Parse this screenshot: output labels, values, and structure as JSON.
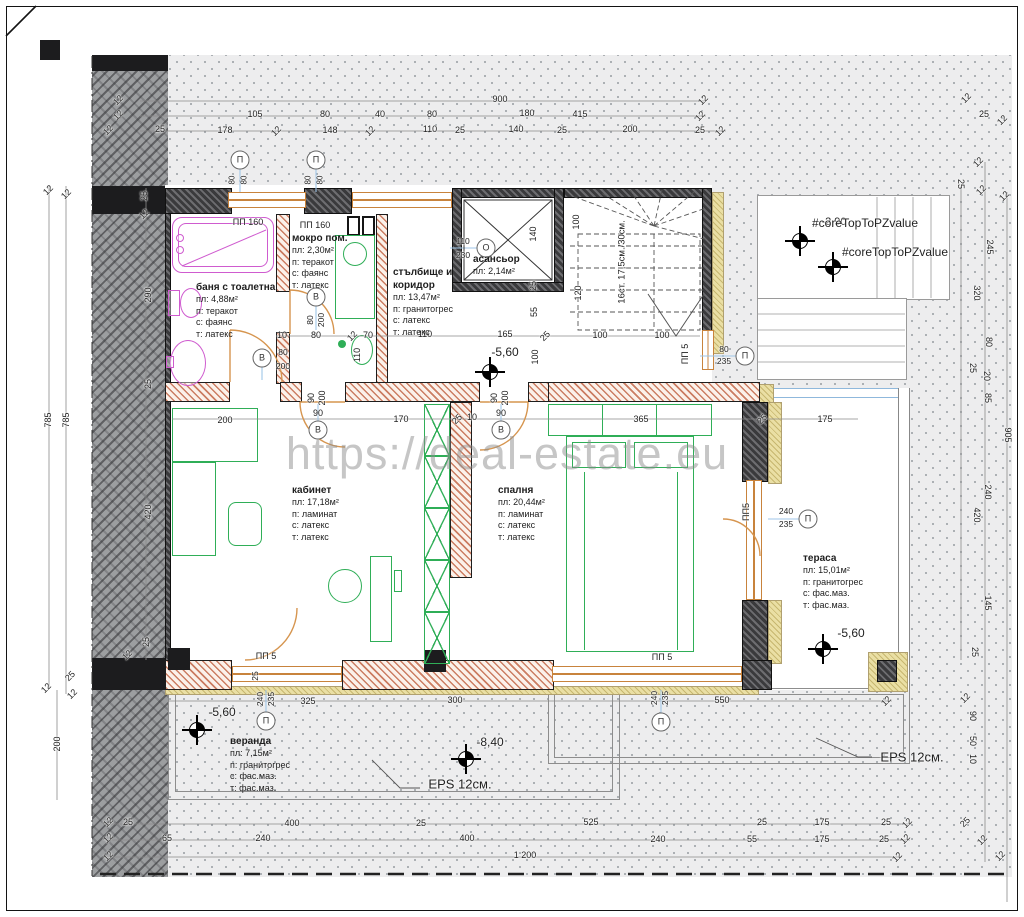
{
  "watermark": "https://deal-estate.eu",
  "colors": {
    "wall_dark": "#3a3a3c",
    "wall_partition_hatch": "#c3694b",
    "insulation_yellow": "#eadfa4",
    "furniture_green": "#2fae57",
    "plumbing_magenta": "#cf5bcf",
    "door_orange": "#d6954f",
    "tag_leader_blue": "#9fc6e8",
    "terrain_dot": "#a4a9ae",
    "watermark_gray": "#8e8e8e"
  },
  "rooms": [
    {
      "title": "баня с тоалетна",
      "lines": [
        "пл: 4,88м²",
        "п: теракот",
        "с: фаянс",
        "т: латекс"
      ],
      "x": 196,
      "y": 281,
      "w": 90
    },
    {
      "title": "мокро пом.",
      "lines": [
        "пл: 2,30м²",
        "п: теракот",
        "с: фаянс",
        "т: латекс"
      ],
      "x": 292,
      "y": 232,
      "w": 70
    },
    {
      "title": "стълбище и коридор",
      "lines": [
        "пл: 13,47м²",
        "п: гранитогрес",
        "с: латекс",
        "т: латекс"
      ],
      "x": 393,
      "y": 266,
      "w": 78
    },
    {
      "title": "асансьор",
      "lines": [
        "пл: 2,14м²"
      ],
      "x": 473,
      "y": 253,
      "w": 70
    },
    {
      "title": "кабинет",
      "lines": [
        "пл: 17,18м²",
        "п: ламинат",
        "с: латекс",
        "т: латекс"
      ],
      "x": 292,
      "y": 484,
      "w": 80
    },
    {
      "title": "спалня",
      "lines": [
        "пл: 20,44м²",
        "п: ламинат",
        "с: латекс",
        "т: латекс"
      ],
      "x": 498,
      "y": 484,
      "w": 80
    },
    {
      "title": "тераса",
      "lines": [
        "пл: 15,01м²",
        "п: гранитогрес",
        "с: фас.маз.",
        "т: фас.маз."
      ],
      "x": 803,
      "y": 552,
      "w": 86
    },
    {
      "title": "веранда",
      "lines": [
        "пл: 7,15м²",
        "п: гранитогрес",
        "с: фас.маз.",
        "т: фас.маз."
      ],
      "x": 230,
      "y": 735,
      "w": 86
    }
  ],
  "annotations": [
    [
      "12",
      118,
      100,
      -45
    ],
    [
      "900",
      500,
      99
    ],
    [
      "12",
      703,
      100,
      -45
    ],
    [
      "12",
      118,
      115,
      -45
    ],
    [
      "105",
      255,
      114
    ],
    [
      "80",
      325,
      114
    ],
    [
      "40",
      380,
      114
    ],
    [
      "80",
      432,
      114
    ],
    [
      "180",
      527,
      113
    ],
    [
      "415",
      580,
      114
    ],
    [
      "12",
      700,
      116,
      -45
    ],
    [
      "12",
      108,
      130,
      -45
    ],
    [
      "25",
      160,
      129
    ],
    [
      "178",
      225,
      130
    ],
    [
      "12",
      276,
      131,
      -45
    ],
    [
      "148",
      330,
      130
    ],
    [
      "12",
      370,
      131,
      -45
    ],
    [
      "110",
      430,
      129
    ],
    [
      "25",
      460,
      130
    ],
    [
      "140",
      516,
      129
    ],
    [
      "25",
      562,
      130
    ],
    [
      "200",
      630,
      129
    ],
    [
      "25",
      700,
      130
    ],
    [
      "12",
      720,
      131,
      -45
    ],
    [
      "12",
      966,
      98,
      -45
    ],
    [
      "25",
      984,
      114
    ],
    [
      "12",
      1002,
      120,
      -45
    ],
    [
      "12",
      48,
      190,
      -45
    ],
    [
      "12",
      66,
      194,
      -45
    ],
    [
      "25",
      144,
      196,
      -90
    ],
    [
      "12",
      144,
      214,
      -45
    ],
    [
      "290",
      148,
      295,
      -90
    ],
    [
      "25",
      148,
      384,
      -90
    ],
    [
      "785",
      48,
      420,
      -90
    ],
    [
      "785",
      66,
      420,
      -90
    ],
    [
      "420",
      148,
      512,
      -90
    ],
    [
      "25",
      146,
      642,
      -90
    ],
    [
      "12",
      127,
      655,
      -45
    ],
    [
      "12",
      46,
      688,
      -45
    ],
    [
      "25",
      70,
      676,
      -45
    ],
    [
      "12",
      72,
      694,
      -45
    ],
    [
      "200",
      57,
      744,
      -90
    ],
    [
      "12",
      978,
      162,
      -45
    ],
    [
      "25",
      961,
      184,
      90
    ],
    [
      "12",
      981,
      190,
      -45
    ],
    [
      "12",
      1004,
      196,
      -45
    ],
    [
      "245",
      990,
      247,
      90
    ],
    [
      "320",
      977,
      293,
      90
    ],
    [
      "80",
      989,
      342,
      90
    ],
    [
      "25",
      973,
      368,
      90
    ],
    [
      "20",
      987,
      376,
      90
    ],
    [
      "85",
      988,
      398,
      90
    ],
    [
      "905",
      1008,
      435,
      90
    ],
    [
      "240",
      988,
      492,
      90
    ],
    [
      "420",
      977,
      515,
      90
    ],
    [
      "145",
      988,
      603,
      90
    ],
    [
      "25",
      975,
      652,
      90
    ],
    [
      "12",
      965,
      698,
      -45
    ],
    [
      "90",
      973,
      716,
      90
    ],
    [
      "50",
      973,
      741,
      90
    ],
    [
      "10",
      973,
      759,
      90
    ],
    [
      "25",
      965,
      822,
      -45
    ],
    [
      "12",
      982,
      840,
      -45
    ],
    [
      "12",
      1000,
      856,
      -45
    ],
    [
      "12",
      108,
      822,
      -45
    ],
    [
      "25",
      128,
      822
    ],
    [
      "400",
      292,
      823
    ],
    [
      "25",
      421,
      823
    ],
    [
      "525",
      591,
      822
    ],
    [
      "25",
      762,
      822
    ],
    [
      "175",
      822,
      822
    ],
    [
      "25",
      886,
      822
    ],
    [
      "12",
      907,
      823,
      -45
    ],
    [
      "12",
      108,
      838,
      -45
    ],
    [
      "65",
      167,
      838
    ],
    [
      "240",
      263,
      838
    ],
    [
      "400",
      467,
      838
    ],
    [
      "240",
      658,
      839
    ],
    [
      "55",
      752,
      839
    ],
    [
      "175",
      822,
      839
    ],
    [
      "25",
      884,
      839
    ],
    [
      "12",
      905,
      839,
      -45
    ],
    [
      "12",
      108,
      856,
      -45
    ],
    [
      "1 200",
      525,
      855
    ],
    [
      "12",
      897,
      857,
      -45
    ],
    [
      "200",
      225,
      420
    ],
    [
      "90",
      318,
      413
    ],
    [
      "170",
      401,
      419
    ],
    [
      "25",
      457,
      419,
      -45
    ],
    [
      "10",
      472,
      417
    ],
    [
      "90",
      501,
      413
    ],
    [
      "365",
      641,
      419
    ],
    [
      "25",
      762,
      419,
      -45
    ],
    [
      "175",
      825,
      419
    ],
    [
      "90",
      311,
      398,
      -90
    ],
    [
      "200",
      322,
      398,
      -90
    ],
    [
      "90",
      494,
      398,
      -90
    ],
    [
      "200",
      505,
      398,
      -90
    ],
    [
      "10",
      282,
      335
    ],
    [
      "80",
      316,
      335
    ],
    [
      "12",
      352,
      336,
      -45
    ],
    [
      "70",
      368,
      335
    ],
    [
      "110",
      425,
      334
    ],
    [
      "165",
      505,
      334
    ],
    [
      "25",
      545,
      336,
      -45
    ],
    [
      "100",
      600,
      335
    ],
    [
      "100",
      662,
      335
    ],
    [
      "110",
      357,
      355,
      -90
    ],
    [
      "100",
      535,
      357,
      -90
    ],
    [
      "140",
      533,
      234,
      -90
    ],
    [
      "25",
      533,
      286,
      -90
    ],
    [
      "55",
      534,
      312,
      -90
    ],
    [
      "100",
      576,
      222,
      -90
    ],
    [
      "120",
      578,
      293,
      -90
    ],
    [
      "110",
      463,
      241,
      0,
      8.5
    ],
    [
      "230",
      463,
      255,
      0,
      8.5
    ],
    [
      "80",
      283,
      352,
      0,
      8.5
    ],
    [
      "200",
      283,
      366,
      0,
      8.5
    ],
    [
      "80",
      310,
      320,
      -90,
      8.5
    ],
    [
      "200",
      321,
      320,
      -90,
      8.5
    ],
    [
      "ПП 160",
      248,
      222
    ],
    [
      "ПП 160",
      315,
      225
    ],
    [
      "80",
      232,
      180,
      -90,
      8
    ],
    [
      "80",
      244,
      180,
      -90,
      8
    ],
    [
      "80",
      308,
      180,
      -90,
      8
    ],
    [
      "80",
      320,
      180,
      -90,
      8
    ],
    [
      "ПП 5",
      685,
      354,
      -90
    ],
    [
      "80",
      724,
      349,
      0,
      8.5
    ],
    [
      "235",
      724,
      361,
      0,
      8.5
    ],
    [
      "ПП5",
      746,
      512,
      -90
    ],
    [
      "240",
      786,
      511,
      0,
      8.5
    ],
    [
      "235",
      786,
      524,
      0,
      8.5
    ],
    [
      "ПП 5",
      266,
      656
    ],
    [
      "240",
      260,
      699,
      -90,
      8.5
    ],
    [
      "235",
      271,
      699,
      -90,
      8.5
    ],
    [
      "25",
      255,
      676,
      -90,
      8.5
    ],
    [
      "325",
      308,
      701
    ],
    [
      "300",
      455,
      700
    ],
    [
      "ПП 5",
      662,
      657
    ],
    [
      "240",
      654,
      698,
      -90,
      8.5
    ],
    [
      "235",
      665,
      698,
      -90,
      8.5
    ],
    [
      "550",
      722,
      700
    ],
    [
      "12",
      886,
      701,
      -45
    ],
    [
      "16ст. 17,5см./30см.",
      622,
      262,
      -90,
      9.5
    ],
    [
      "-5,60",
      505,
      352,
      0,
      12
    ],
    [
      "-5,60",
      851,
      633,
      0,
      12
    ],
    [
      "-5,60",
      222,
      712,
      0,
      12
    ],
    [
      "-8,40",
      490,
      742,
      0,
      12
    ],
    [
      "-2,90",
      834,
      222,
      0,
      11
    ],
    [
      "#coreTopToPZvalue",
      865,
      223,
      0,
      12
    ],
    [
      "#coreTopToPZvalue",
      895,
      252,
      0,
      12
    ],
    [
      "EPS 12см.",
      460,
      784,
      0,
      13
    ],
    [
      "EPS 12см.",
      912,
      757,
      0,
      13
    ]
  ],
  "circles": [
    {
      "t": "П",
      "x": 240,
      "y": 160
    },
    {
      "t": "П",
      "x": 316,
      "y": 160
    },
    {
      "t": "О",
      "x": 486,
      "y": 248
    },
    {
      "t": "В",
      "x": 262,
      "y": 358
    },
    {
      "t": "В",
      "x": 316,
      "y": 297
    },
    {
      "t": "В",
      "x": 318,
      "y": 430
    },
    {
      "t": "В",
      "x": 501,
      "y": 430
    },
    {
      "t": "П",
      "x": 745,
      "y": 356
    },
    {
      "t": "П",
      "x": 808,
      "y": 519
    },
    {
      "t": "П",
      "x": 266,
      "y": 721
    },
    {
      "t": "П",
      "x": 661,
      "y": 722
    }
  ],
  "markers": [
    {
      "x": 490,
      "y": 372
    },
    {
      "x": 823,
      "y": 649
    },
    {
      "x": 197,
      "y": 730
    },
    {
      "x": 466,
      "y": 759
    },
    {
      "x": 800,
      "y": 241
    },
    {
      "x": 833,
      "y": 267
    }
  ]
}
